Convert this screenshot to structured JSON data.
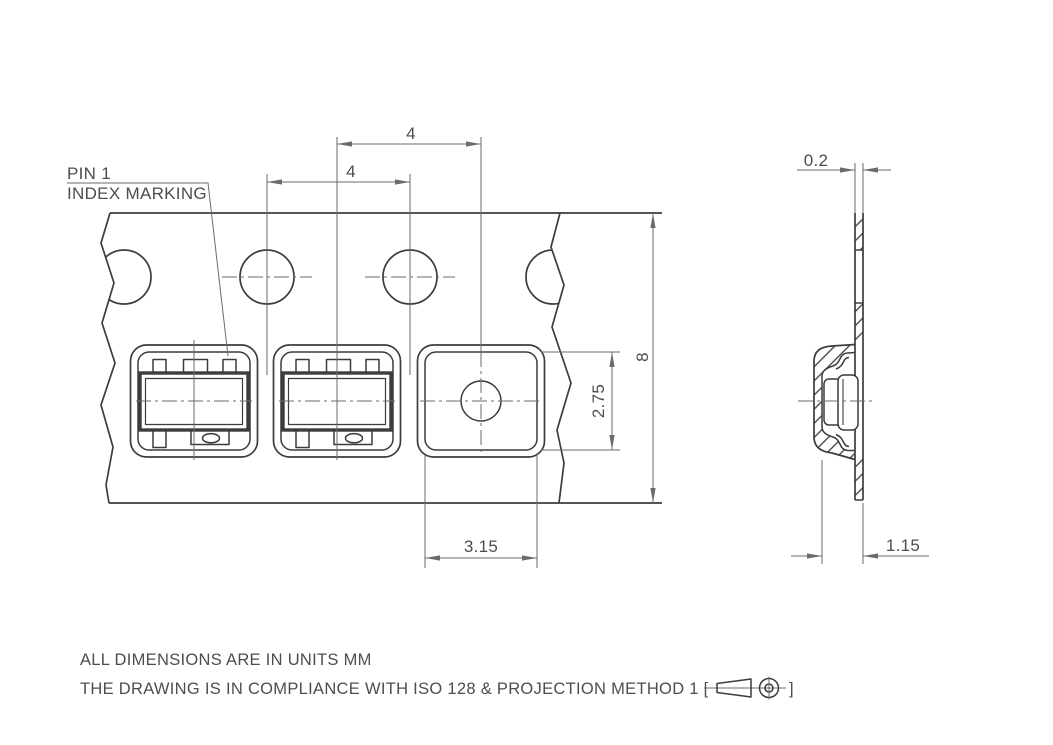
{
  "drawing": {
    "labels": {
      "pin1_line1": "PIN 1",
      "pin1_line2": "INDEX MARKING"
    },
    "dimensions": {
      "pocket_pitch": "4",
      "sprocket_hole_pitch": "4",
      "tape_width": "8",
      "pocket_width": "2.75",
      "pocket_length": "3.15",
      "tape_thickness": "0.2",
      "pocket_depth": "1.15"
    },
    "notes": {
      "line1": "ALL DIMENSIONS ARE IN UNITS MM",
      "line2_prefix": "THE DRAWING IS IN COMPLIANCE WITH ISO 128 & PROJECTION METHOD 1 [",
      "line2_suffix": "]"
    },
    "symbols": {
      "projection_method": "first-angle-projection"
    },
    "colors": {
      "line": "#3c3c3c",
      "thin_line": "#6b6b6b",
      "text": "#4d4d4d",
      "background": "#ffffff"
    }
  }
}
